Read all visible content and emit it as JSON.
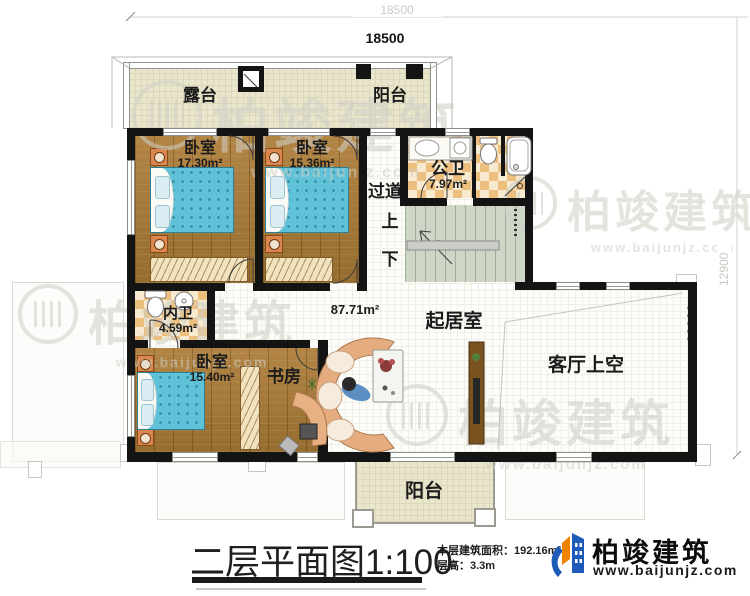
{
  "dimensions": {
    "top_outer": "18500",
    "top_inner": "18500",
    "right_outer": "12900",
    "right_inner": "12900"
  },
  "rooms": {
    "terrace": {
      "name": "露台"
    },
    "balcony_top": {
      "name": "阳台"
    },
    "bedroom_1": {
      "name": "卧室",
      "area": "17.30m²"
    },
    "bedroom_2": {
      "name": "卧室",
      "area": "15.36m²"
    },
    "public_bath": {
      "name": "公卫",
      "area": "7.97m²"
    },
    "corridor": {
      "name": "过道"
    },
    "stair_up": {
      "name": "上"
    },
    "stair_down": {
      "name": "下"
    },
    "ensuite_bath": {
      "name": "内卫",
      "area": "4.59m²"
    },
    "bedroom_3": {
      "name": "卧室",
      "area": "15.40m²"
    },
    "study": {
      "name": "书房"
    },
    "living": {
      "name": "起居室",
      "area": "87.71m²"
    },
    "living_void": {
      "name": "客厅上空"
    },
    "balcony_bottom": {
      "name": "阳台"
    }
  },
  "title_block": {
    "title": "二层平面图1:100",
    "floor_area": "本层建筑面积：192.16m²",
    "floor_height": "层高：3.3m"
  },
  "brand": {
    "name": "柏竣建筑",
    "url": "www.baijunjz.com"
  },
  "watermark": {
    "name": "柏竣建筑",
    "url": "www.baijunjz.com"
  },
  "colors": {
    "wall": "#141414",
    "wood_floor": "#a87c3e",
    "beige_tile": "#eae6cd",
    "checker_tan": "#ecbf7f",
    "stair_green": "#cdd6c7",
    "bed_blue": "#5fc2d9",
    "brand_blue": "#1e5bb8",
    "brand_orange": "#f08300"
  }
}
